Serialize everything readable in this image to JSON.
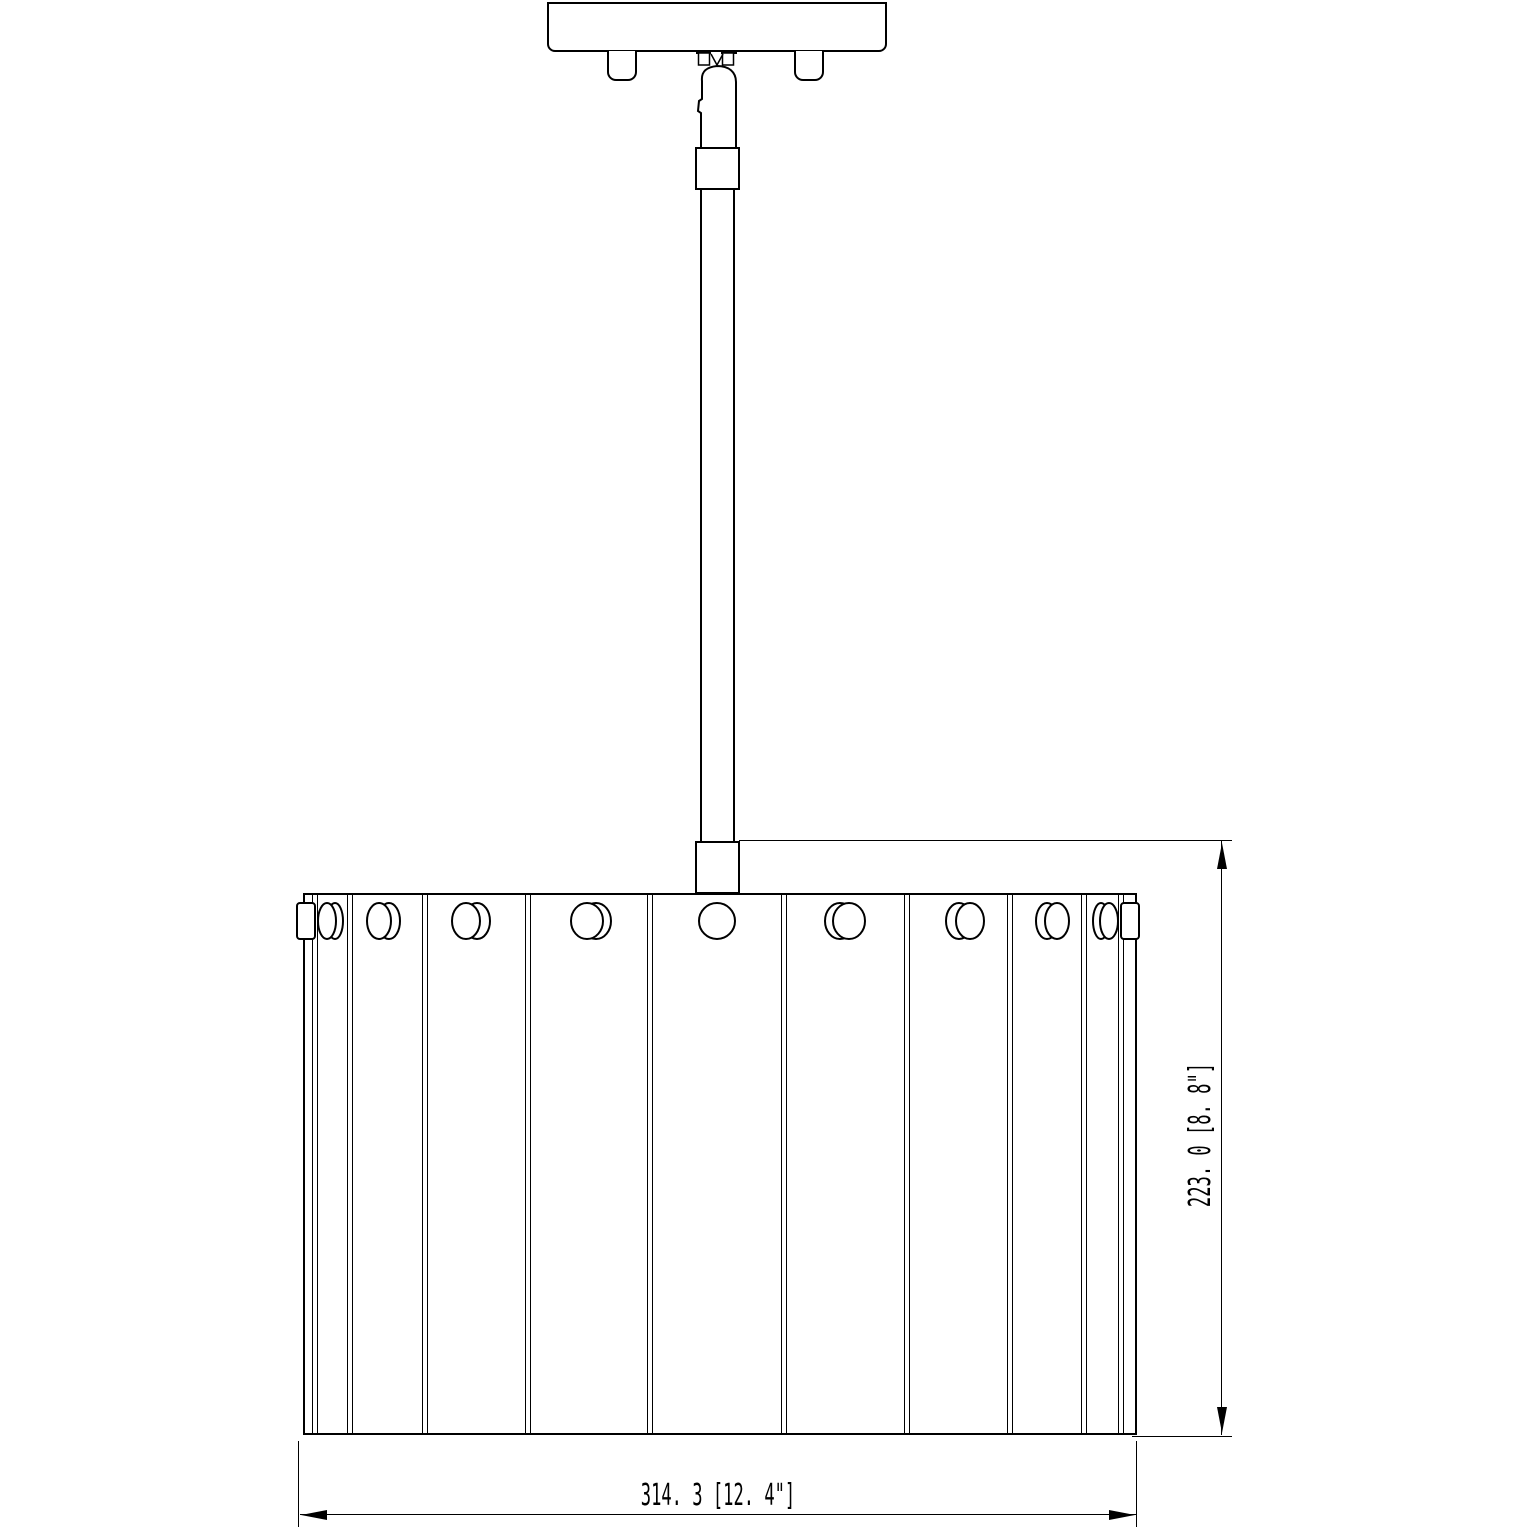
{
  "style": {
    "line_color": "#000000",
    "background": "#ffffff"
  },
  "dimensions": {
    "width": {
      "label": "314. 3 [12. 4\"]",
      "mm": 314.3,
      "inches": 12.4
    },
    "height": {
      "label": "223. 0 [8. 8\"]",
      "mm": 223.0,
      "inches": 8.8
    }
  },
  "drum": {
    "dividers_x": [
      315,
      350,
      425,
      528,
      650,
      784,
      907,
      1010,
      1084,
      1121
    ],
    "knob_cy": 921,
    "knob_ry": 18,
    "knobs": [
      {
        "front_cx": 327,
        "back_cx": 335,
        "rx": 9
      },
      {
        "front_cx": 379,
        "back_cx": 389,
        "rx": 12
      },
      {
        "front_cx": 466,
        "back_cx": 477,
        "rx": 14
      },
      {
        "front_cx": 587,
        "back_cx": 596,
        "rx": 16
      },
      {
        "front_cx": 717,
        "back_cx": 717,
        "rx": 18
      },
      {
        "front_cx": 849,
        "back_cx": 840,
        "rx": 16
      },
      {
        "front_cx": 970,
        "back_cx": 959,
        "rx": 14
      },
      {
        "front_cx": 1057,
        "back_cx": 1047,
        "rx": 12
      },
      {
        "front_cx": 1109,
        "back_cx": 1101,
        "rx": 9
      }
    ]
  }
}
